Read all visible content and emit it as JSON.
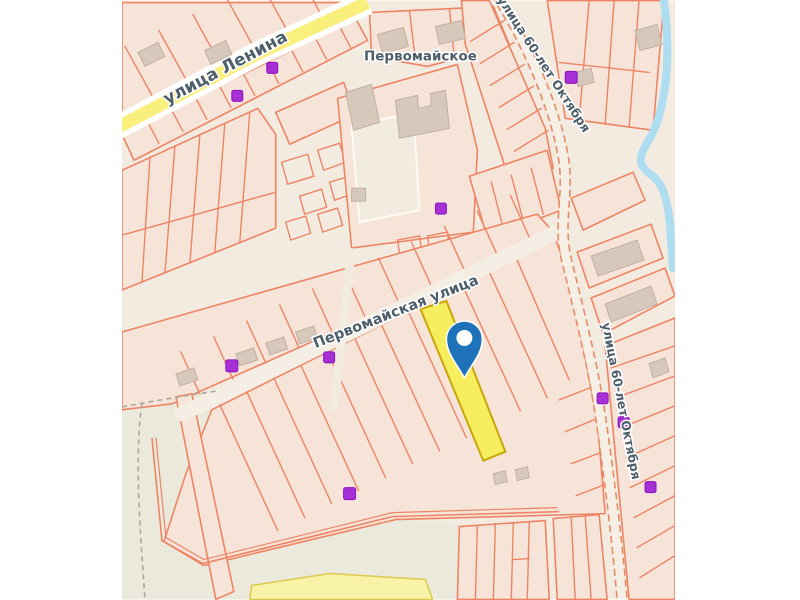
{
  "map": {
    "place_label": "Первомайское",
    "streets": {
      "lenina": "улица Ленина",
      "pervomayskaya": "Первомайская улица",
      "oktyabrya_top": "улица 60-лет Октября",
      "oktyabrya_right": "улица 60-лет Октября"
    },
    "highlighted_parcel": {
      "fill": "#f7ee5e",
      "stroke": "#c9a50a"
    },
    "pin_color": "#1d72b9",
    "poi_color": "#a62fd6",
    "water_color": "#aedcf0",
    "road_yellow_color": "#f8ef7d",
    "parcel_outline_color": "#ed8464",
    "parcel_fill_color": "#f7e4d9",
    "map_background_color": "#f3ebe0",
    "label_color": "#4e5f6c"
  }
}
